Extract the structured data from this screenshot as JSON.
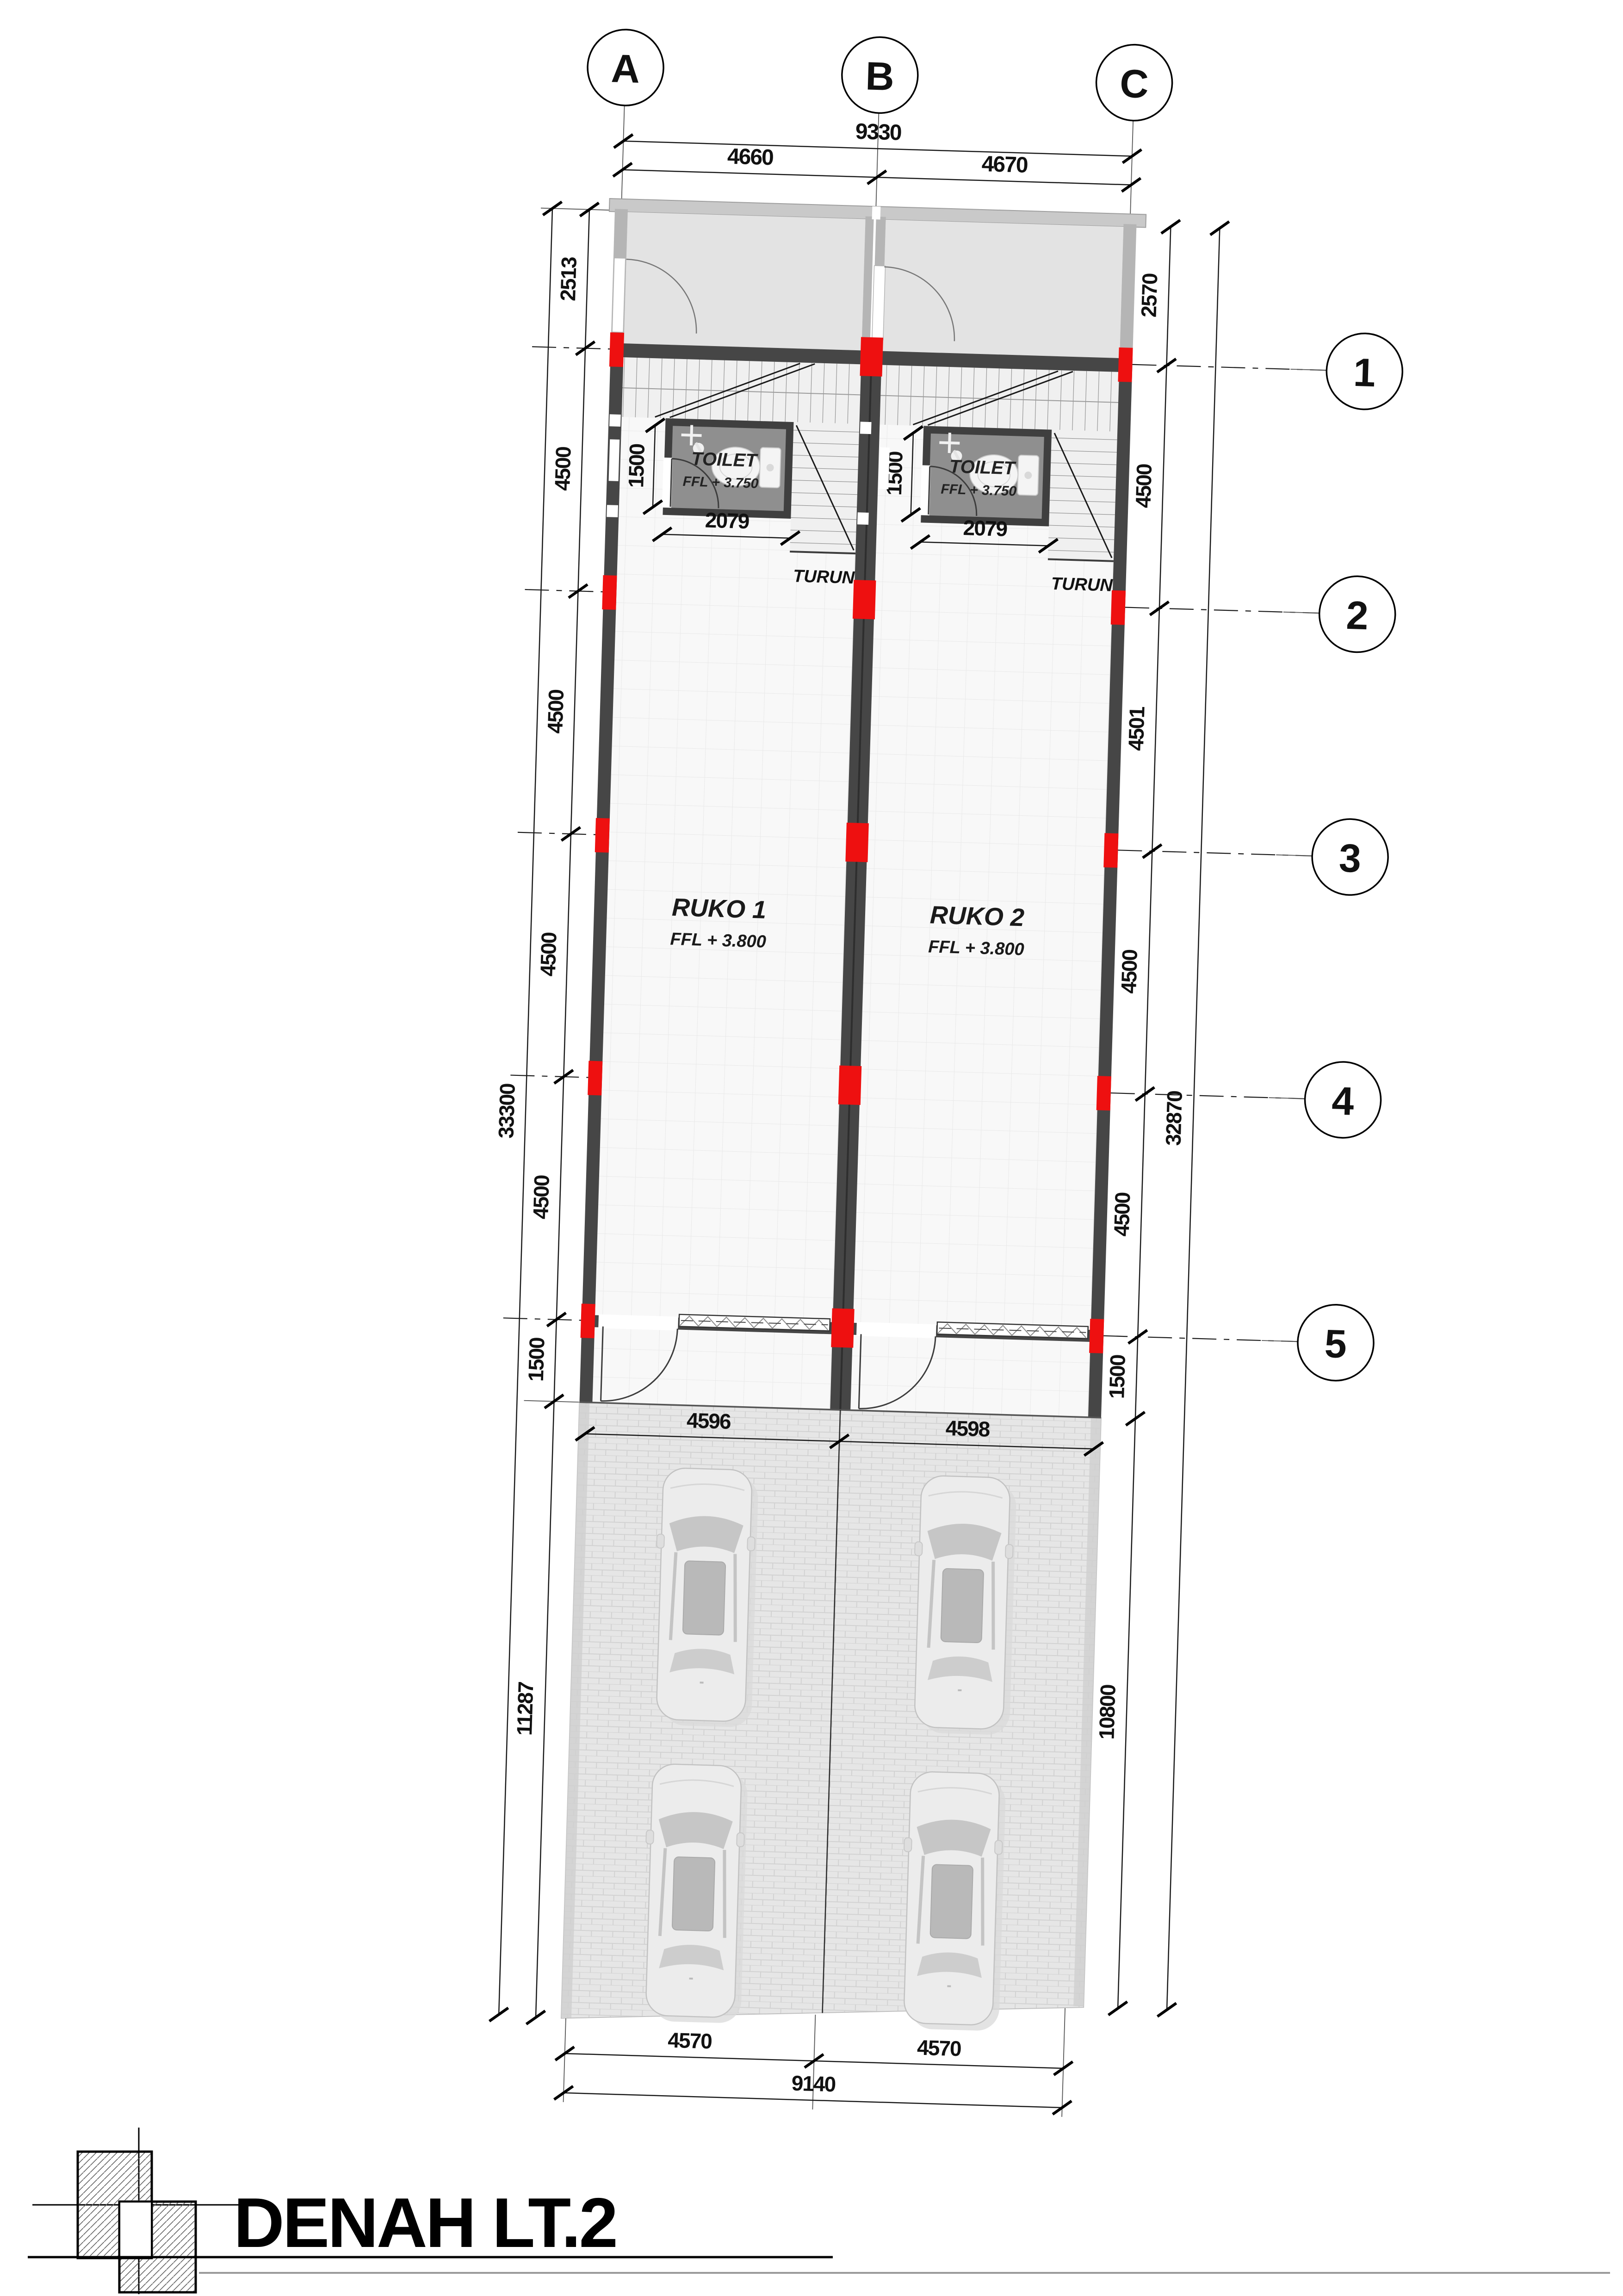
{
  "title": {
    "text": "DENAH LT.2"
  },
  "grid": {
    "cols": [
      "A",
      "B",
      "C"
    ],
    "rows": [
      "1",
      "2",
      "3",
      "4",
      "5"
    ]
  },
  "dims": {
    "top": {
      "total": "9330",
      "ab": "4660",
      "bc": "4670"
    },
    "left": {
      "segments": [
        "2513",
        "4500",
        "4500",
        "4500",
        "4500",
        "1500"
      ],
      "overall": "33300",
      "parking": "11287"
    },
    "right": {
      "segments": [
        "2570",
        "4500",
        "4501",
        "4500",
        "4500",
        "1500"
      ],
      "overall": "32870",
      "parking": "10800"
    },
    "front": {
      "ab": "4596",
      "bc": "4598"
    },
    "site": {
      "left": "4570",
      "right": "4570",
      "total": "9140"
    },
    "toilet": {
      "width": "2079",
      "height": "1500"
    }
  },
  "rooms": [
    {
      "name": "RUKO 1",
      "ffl": "FFL + 3.800"
    },
    {
      "name": "RUKO 2",
      "ffl": "FFL + 3.800"
    }
  ],
  "toilets": [
    {
      "name": "TOILET",
      "ffl": "FFL + 3.750"
    },
    {
      "name": "TOILET",
      "ffl": "FFL + 3.750"
    }
  ],
  "stairs": {
    "down_label": "TURUN"
  },
  "colors": {
    "accent_red": "#ee1010",
    "wall_dark": "#464646",
    "wall_light": "#b5b5b5"
  }
}
